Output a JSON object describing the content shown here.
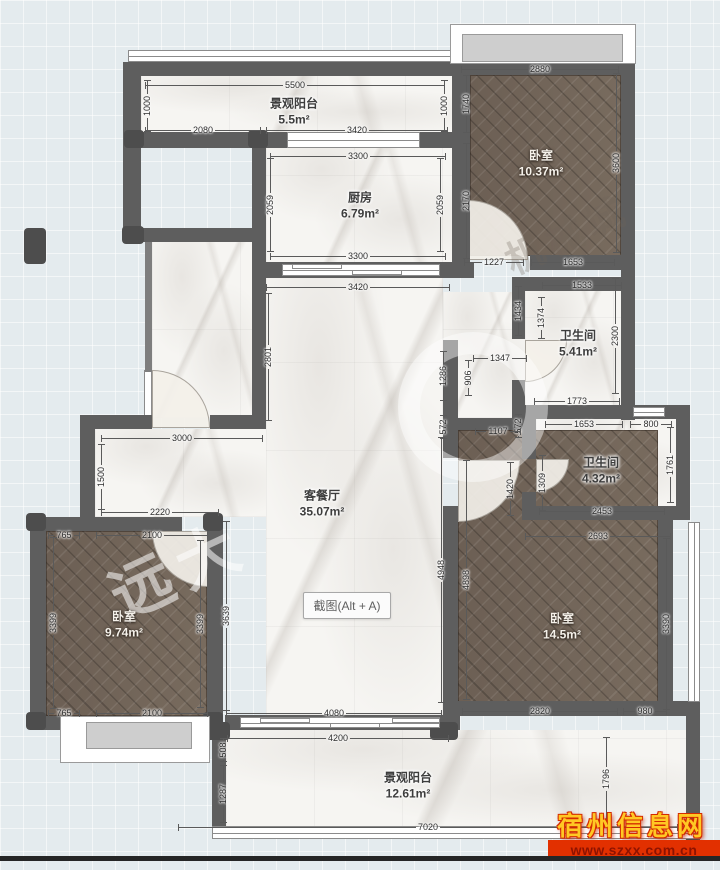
{
  "app": {
    "screenshot_button": "截图(Alt + A)"
  },
  "rooms": {
    "balcony_top": {
      "name": "景观阳台",
      "area": "5.5m²"
    },
    "kitchen": {
      "name": "厨房",
      "area": "6.79m²"
    },
    "bedroom_top_right": {
      "name": "卧室",
      "area": "10.37m²"
    },
    "bathroom_1": {
      "name": "卫生间",
      "area": "5.41m²"
    },
    "bathroom_2": {
      "name": "卫生间",
      "area": "4.32m²"
    },
    "living_dining": {
      "name": "客餐厅",
      "area": "35.07m²"
    },
    "bedroom_bottom_left": {
      "name": "卧室",
      "area": "9.74m²"
    },
    "bedroom_bottom_right": {
      "name": "卧室",
      "area": "14.5m²"
    },
    "balcony_bottom": {
      "name": "景观阳台",
      "area": "12.61m²"
    }
  },
  "watermarks": {
    "site_name": "宿州信息网",
    "site_url": "www.szxx.com.cn",
    "brand_1": "远大",
    "brand_2": "机械城"
  },
  "colors": {
    "wall": "#5e5e5e",
    "wood_floor": "#6f6257",
    "marble_floor": "#f6f5f2",
    "site_name_gold": "#ffc824",
    "site_url_red": "#e23000"
  },
  "dimensions": [
    {
      "t": "5500",
      "x": 295,
      "y": 85,
      "o": "h",
      "l": 300
    },
    {
      "t": "1000",
      "x": 147,
      "y": 106,
      "o": "v",
      "l": 52
    },
    {
      "t": "2080",
      "x": 203,
      "y": 130,
      "o": "h",
      "l": 116
    },
    {
      "t": "3420",
      "x": 357,
      "y": 130,
      "o": "h",
      "l": 182
    },
    {
      "t": "1000",
      "x": 444,
      "y": 106,
      "o": "v",
      "l": 52
    },
    {
      "t": "1740",
      "x": 466,
      "y": 104,
      "o": "v",
      "l": 58
    },
    {
      "t": "2880",
      "x": 540,
      "y": 69,
      "o": "h",
      "l": 158
    },
    {
      "t": "2170",
      "x": 466,
      "y": 201,
      "o": "v",
      "l": 116
    },
    {
      "t": "3600",
      "x": 616,
      "y": 163,
      "o": "v",
      "l": 180
    },
    {
      "t": "3300",
      "x": 358,
      "y": 156,
      "o": "h",
      "l": 176
    },
    {
      "t": "2059",
      "x": 270,
      "y": 205,
      "o": "v",
      "l": 94
    },
    {
      "t": "2059",
      "x": 440,
      "y": 205,
      "o": "v",
      "l": 94
    },
    {
      "t": "3300",
      "x": 358,
      "y": 256,
      "o": "h",
      "l": 176
    },
    {
      "t": "1227",
      "x": 494,
      "y": 262,
      "o": "h",
      "l": 60
    },
    {
      "t": "1653",
      "x": 573,
      "y": 262,
      "o": "h",
      "l": 84
    },
    {
      "t": "3420",
      "x": 358,
      "y": 287,
      "o": "h",
      "l": 184
    },
    {
      "t": "2801",
      "x": 268,
      "y": 357,
      "o": "v",
      "l": 128
    },
    {
      "t": "1533",
      "x": 582,
      "y": 285,
      "o": "h",
      "l": 80
    },
    {
      "t": "1434",
      "x": 518,
      "y": 311,
      "o": "v",
      "l": 50
    },
    {
      "t": "1374",
      "x": 541,
      "y": 318,
      "o": "v",
      "l": 42
    },
    {
      "t": "2300",
      "x": 615,
      "y": 336,
      "o": "v",
      "l": 116
    },
    {
      "t": "1347",
      "x": 500,
      "y": 358,
      "o": "h",
      "l": 54
    },
    {
      "t": "1286",
      "x": 443,
      "y": 376,
      "o": "v",
      "l": 50
    },
    {
      "t": "906",
      "x": 468,
      "y": 378,
      "o": "v",
      "l": 36
    },
    {
      "t": "572",
      "x": 443,
      "y": 427,
      "o": "v",
      "l": 24
    },
    {
      "t": "572",
      "x": 518,
      "y": 426,
      "o": "v",
      "l": 24
    },
    {
      "t": "1107",
      "x": 498,
      "y": 431,
      "o": "h",
      "l": 46
    },
    {
      "t": "1773",
      "x": 577,
      "y": 401,
      "o": "h",
      "l": 86
    },
    {
      "t": "1653",
      "x": 584,
      "y": 424,
      "o": "h",
      "l": 78
    },
    {
      "t": "800",
      "x": 651,
      "y": 424,
      "o": "h",
      "l": 42
    },
    {
      "t": "1420",
      "x": 510,
      "y": 489,
      "o": "v",
      "l": 54
    },
    {
      "t": "1309",
      "x": 542,
      "y": 483,
      "o": "v",
      "l": 56
    },
    {
      "t": "1761",
      "x": 670,
      "y": 465,
      "o": "v",
      "l": 76
    },
    {
      "t": "2453",
      "x": 602,
      "y": 511,
      "o": "h",
      "l": 126
    },
    {
      "t": "2693",
      "x": 598,
      "y": 536,
      "o": "h",
      "l": 146
    },
    {
      "t": "3000",
      "x": 182,
      "y": 438,
      "o": "h",
      "l": 162
    },
    {
      "t": "1500",
      "x": 101,
      "y": 477,
      "o": "v",
      "l": 66
    },
    {
      "t": "2220",
      "x": 160,
      "y": 512,
      "o": "h",
      "l": 118
    },
    {
      "t": "765",
      "x": 64,
      "y": 535,
      "o": "h",
      "l": 32
    },
    {
      "t": "2100",
      "x": 152,
      "y": 535,
      "o": "h",
      "l": 112
    },
    {
      "t": "3399",
      "x": 53,
      "y": 623,
      "o": "v",
      "l": 172
    },
    {
      "t": "3399",
      "x": 200,
      "y": 624,
      "o": "v",
      "l": 168
    },
    {
      "t": "3639",
      "x": 226,
      "y": 616,
      "o": "v",
      "l": 190
    },
    {
      "t": "765",
      "x": 64,
      "y": 713,
      "o": "h",
      "l": 32
    },
    {
      "t": "2100",
      "x": 152,
      "y": 713,
      "o": "h",
      "l": 112
    },
    {
      "t": "4948",
      "x": 441,
      "y": 570,
      "o": "v",
      "l": 266
    },
    {
      "t": "4898",
      "x": 466,
      "y": 580,
      "o": "v",
      "l": 240
    },
    {
      "t": "3390",
      "x": 666,
      "y": 624,
      "o": "v",
      "l": 172
    },
    {
      "t": "2820",
      "x": 540,
      "y": 711,
      "o": "h",
      "l": 156
    },
    {
      "t": "980",
      "x": 645,
      "y": 711,
      "o": "h",
      "l": 44
    },
    {
      "t": "4080",
      "x": 334,
      "y": 713,
      "o": "h",
      "l": 216
    },
    {
      "t": "4200",
      "x": 338,
      "y": 738,
      "o": "h",
      "l": 222
    },
    {
      "t": "508",
      "x": 223,
      "y": 750,
      "o": "v",
      "l": 24
    },
    {
      "t": "1287",
      "x": 223,
      "y": 794,
      "o": "v",
      "l": 58
    },
    {
      "t": "7020",
      "x": 428,
      "y": 827,
      "o": "h",
      "l": 500
    },
    {
      "t": "1796",
      "x": 606,
      "y": 779,
      "o": "v",
      "l": 84
    }
  ]
}
